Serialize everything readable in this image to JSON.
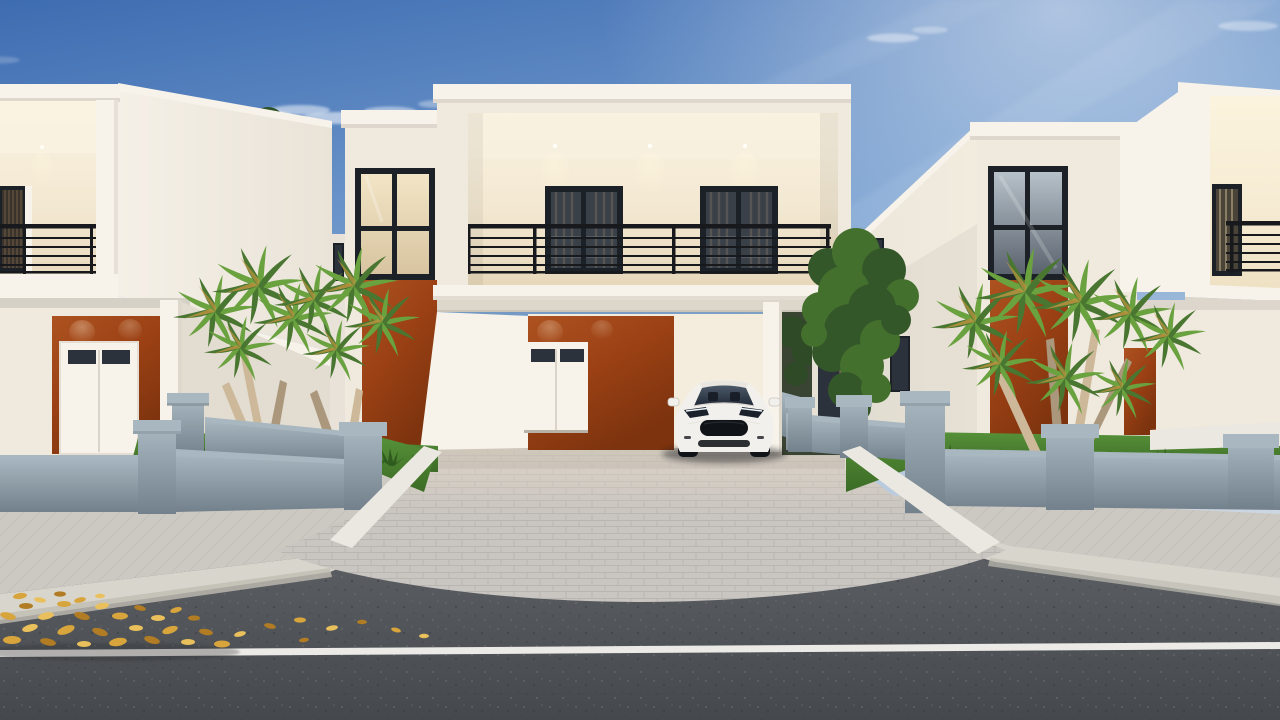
{
  "meta": {
    "type": "architectural-3d-render",
    "subject": "Street view of modern two-story white houses with burnt-orange accent walls, open carport with white sedan, palm trees, grey-blue boundary fences, paver driveway and asphalt road with fallen golden leaves",
    "visible_text": "none"
  },
  "palette": {
    "sky_top": "#3e6cb1",
    "sky_mid": "#7ea6d4",
    "sky_horizon": "#ccd6e1",
    "wall_bright": "#f7f3ea",
    "wall_lit": "#efe9de",
    "wall_shade": "#e2dcd1",
    "soffit": "#dcd6cb",
    "fascia_lip": "#ddd7cd",
    "interior_top": "#faf3e1",
    "interior_warm": "#f3e8d2",
    "interior_deep": "#e7d8ba",
    "warm_glass_top": "#f2e5c6",
    "warm_glass_bot": "#d8c4a0",
    "cool_glass_top": "#b7c1ca",
    "cool_glass_bot": "#5b646e",
    "orange_light": "#ad5220",
    "orange_mid": "#9a4014",
    "orange_dark": "#7c330e",
    "frame_dark": "#1c2127",
    "glass_dark": "#2b323c",
    "glass_streak": "#8b949e",
    "railing": "#17191d",
    "fence_light": "#a8b7c0",
    "fence_mid": "#8ea1ac",
    "fence_dark": "#73818c",
    "grass_hi": "#569138",
    "grass_lo": "#3c6b26",
    "grass_dark": "#2f5c1e",
    "frond": "#6aa23f",
    "frond_dark": "#497630",
    "frond_dry": "#c09440",
    "trunk": "#cdb99a",
    "trunk_shade": "#ab977b",
    "conifer": "#2d5226",
    "leafy": "#44702e",
    "leafy_dark": "#34572a",
    "foliage_dark": "#2e4a26",
    "paver": "#c9c5c0",
    "paver_line": "#b2aeaa",
    "drive_fade": "#e0d6c7",
    "sidewalk": "#ccc8c2",
    "sidewalk_line": "#bab6b0",
    "curb": "#d8d5cc",
    "curb_face": "#c0bdb3",
    "asphalt_top": "#5d6165",
    "asphalt_bot": "#45494d",
    "fleck_light": "#71757a",
    "fleck_dark": "#37393d",
    "road_line": "#eceae6",
    "leaf1": "#d8a43c",
    "leaf2": "#b17c24",
    "leaf3": "#e9c05c",
    "white_edge": "#ebe8e1",
    "porch_floor": "#d9cfc1",
    "car_body": "#f2f0ec",
    "car_roof": "#e9e6e0",
    "car_glass_top": "#4b5868",
    "car_glass_bot": "#222a36",
    "car_dark": "#101318",
    "car_led": "#edf3f8"
  },
  "scene": {
    "sky": {
      "condition": "clear blue with wispy clouds and sun glow upper right"
    },
    "houses": [
      {
        "id": "left-house",
        "style": "white two-story, recessed lit balcony with black railing, orange accent wall with white double entry door"
      },
      {
        "id": "center-house",
        "style": "white two-story, wide lit balcony with two dark glass doors, tower with lit 4-pane window, orange accents, open carport"
      },
      {
        "id": "right-house",
        "style": "white two-story, tall 4-pane window over orange accent, far-right lit balcony, orange side door"
      }
    ],
    "vehicle": {
      "id": "white-sedan",
      "position": "parked in center carport facing street"
    },
    "landscape": {
      "trees": [
        "conifer behind left house",
        "two multi-trunk palms left bed",
        "leafy tree between houses",
        "large multi-crown palm right bed"
      ],
      "fences": "grey-blue rendered walls with capped pillars both sides"
    },
    "road": {
      "features": [
        "herringbone sidewalks",
        "concrete curbs",
        "paver driveway",
        "asphalt road",
        "white lane line",
        "pile of fallen golden leaves lower left"
      ]
    }
  }
}
